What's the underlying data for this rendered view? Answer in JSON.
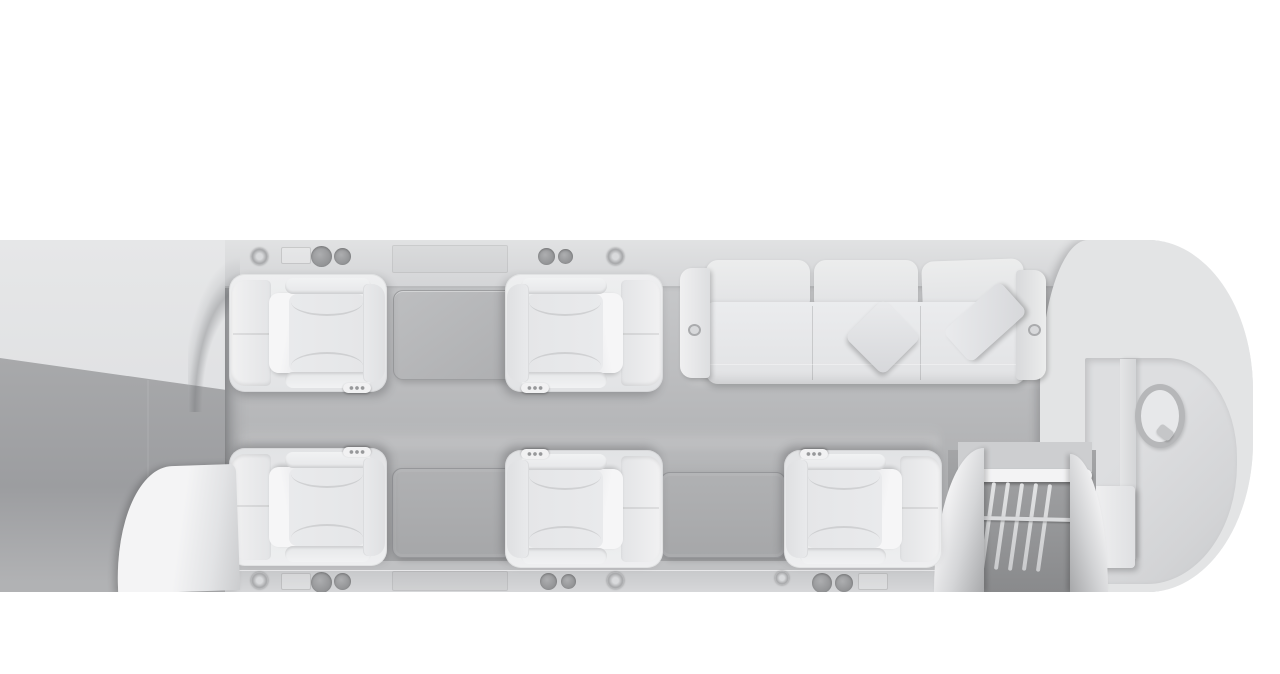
{
  "scene": {
    "type": "3d-render-top-down-cutaway",
    "subject": "private jet cabin interior floor plan",
    "background_color": "#ffffff",
    "text_content": "none"
  },
  "palette": {
    "background": "#ffffff",
    "fuselage_roof": "#e3e4e5",
    "wall_band": "#d5d6d8",
    "floor_top": "#c7c8ca",
    "floor_bottom": "#9fa0a2",
    "seat_upholstery": "#ededee",
    "pillow": "#f4f4f5",
    "table_top_light": "#b3b4b6",
    "table_dark": "#a8a9ab",
    "speaker_grille": "#96979a",
    "stair_well": "#8a8b8d",
    "partition_white": "#f3f3f4"
  },
  "labels": {
    "fuselage": "aircraft fuselage cutaway",
    "forward_roof": "forward fuselage roof (uncut)",
    "forward_interior": "forward interior below cut",
    "cabin_floor": "cabin floor",
    "top_wall": "upper sidewall trim band",
    "bottom_wall": "lower sidewall trim band",
    "seat1": "club seat 1 (top row, faces aft)",
    "seat2": "club seat 2 (top row, faces forward)",
    "seat3": "club seat 3 (bottom row, faces aft)",
    "seat4": "club seat 4 (bottom row, faces forward)",
    "seat5": "club seat 5 (bottom row, faces forward)",
    "table_top": "conference table between facing seats",
    "table_bottom": "table between facing seats (bottom row)",
    "credenza": "side table / credenza",
    "sofa": "three-place divan sofa",
    "pillow_diamond": "throw pillow (diamond)",
    "pillow_angled": "throw pillow (angled against armrest)",
    "partition_door": "curved partition door (forward left)",
    "vestibule": "entry vestibule with airstair",
    "stairs": "airstair with railing balusters",
    "lavatory": "aft lavatory",
    "toilet": "toilet fixture",
    "lav_cabinet": "lavatory cabinet",
    "speakers": "ceiling speaker pair",
    "rosette": "trim rosette fitting",
    "plate": "trim access plate"
  },
  "cabin": {
    "club_seats": 5,
    "sofa_places": 3,
    "tables": 3,
    "throw_pillows": 2,
    "speaker_pairs": 4,
    "rosettes": 4,
    "lavatory_fixtures": [
      "toilet",
      "cabinet"
    ],
    "stair_balusters": 5,
    "seating_layout": {
      "top_row": [
        "club-seat",
        "table",
        "club-seat",
        "three-seat-sofa"
      ],
      "bottom_row": [
        "club-seat",
        "table",
        "club-seat",
        "credenza",
        "club-seat"
      ],
      "aft": [
        "entry-airstair",
        "lavatory"
      ]
    }
  }
}
